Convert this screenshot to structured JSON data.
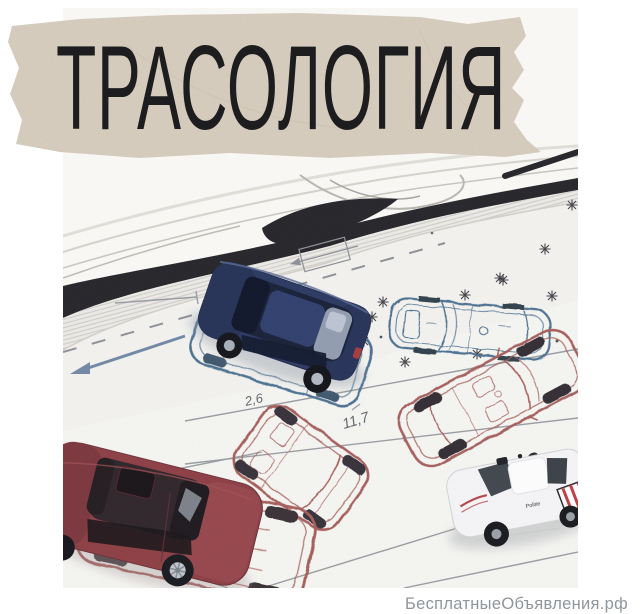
{
  "banner": {
    "title": "ТРАСОЛОГИЯ"
  },
  "watermark": {
    "text": "БесплатныеОбъявления.рф"
  },
  "photo": {
    "annotations": {
      "dim_small": "2,6",
      "dim_large": "11,7",
      "dim_tiny": "12"
    },
    "police_label": "Politie"
  },
  "colors": {
    "tape": "#d9cfc0",
    "banner_text": "#1d1d1f",
    "watermark_text": "#8f969b",
    "blue_ink": "#4e7292",
    "red_ink": "#a65f5b",
    "navy_car": "#2c3a63",
    "red_car": "#8d4046",
    "police_stripe": "#c03f42",
    "paper": "#f3f2ef"
  }
}
